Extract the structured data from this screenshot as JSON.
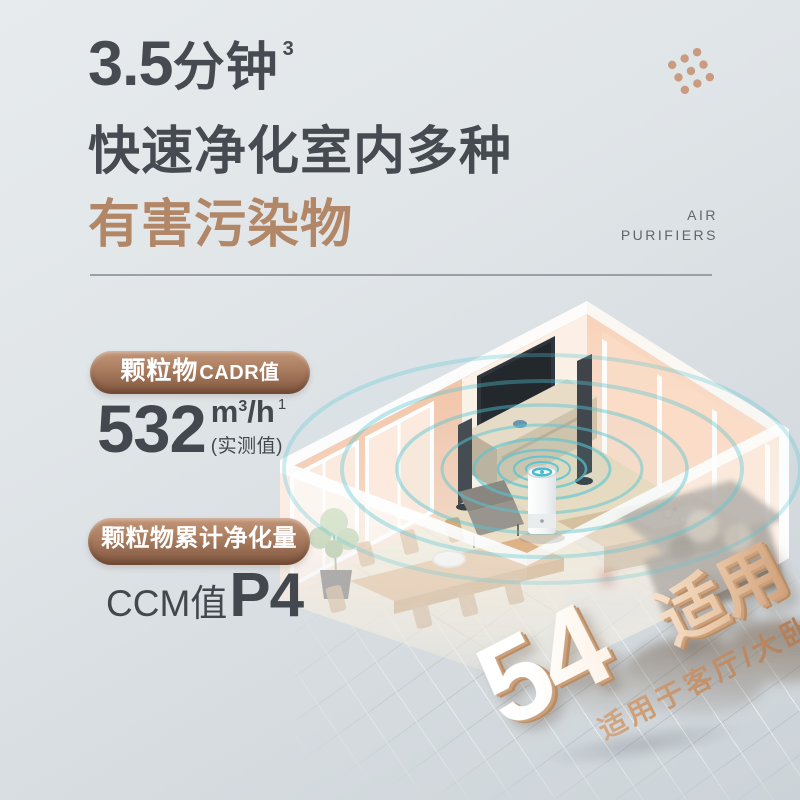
{
  "poster": {
    "background": {
      "top_color": "#e7ebed",
      "bottom_color": "#ccd3d8"
    },
    "headline": {
      "line1_number": "3.5",
      "line1_text": "分钟",
      "line1_superscript": "3",
      "line2": "快速净化室内多种",
      "line3": "有害污染物",
      "dark_color": "#464b51",
      "accent_color": "#b28767"
    },
    "brand_mark": {
      "label_line1": "AIR",
      "label_line2": "PURIFIERS",
      "dots_color": "#cb9b80"
    },
    "stats": [
      {
        "badge_main": "颗粒物",
        "badge_suffix": "CADR值",
        "value": "532",
        "unit_base": "m",
        "unit_sup": "3",
        "unit_divider": "/h",
        "unit_footnote": "1",
        "note": "(实测值)"
      },
      {
        "badge_main": "颗粒物累计净化量",
        "value_label": "CCM值",
        "value": "P4"
      }
    ],
    "badge_colors": {
      "top": "#c39678",
      "bottom": "#7f563f"
    },
    "area_claim": {
      "number": "54",
      "unit_base": "m",
      "unit_sup": "2",
      "suffix": "适用",
      "subtitle": "适用于客厅/大卧室"
    },
    "room_scene": {
      "wall_color": "#f5c9ab",
      "floor_color": "#ecdfc6",
      "ripple_color": "#55c5d3"
    }
  }
}
